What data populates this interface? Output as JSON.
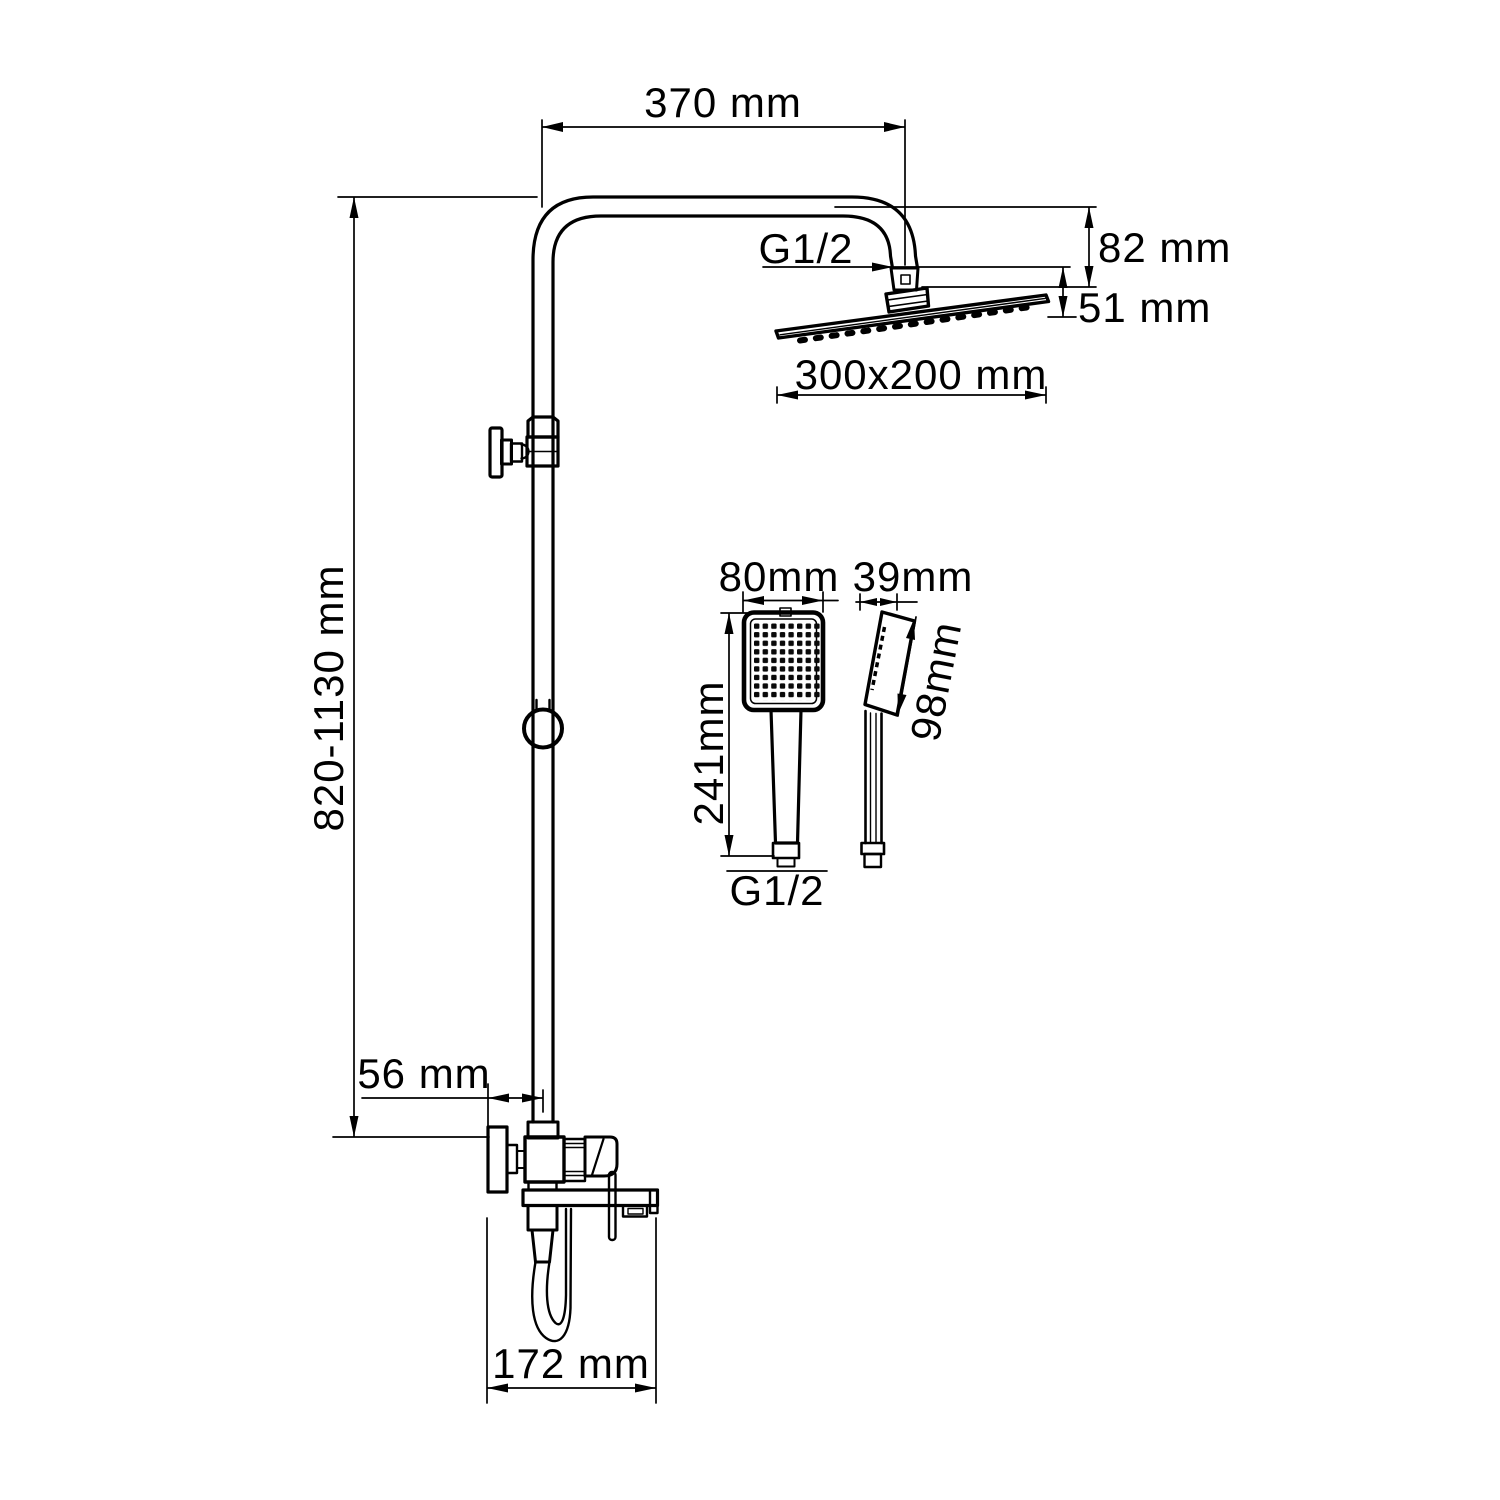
{
  "drawing": {
    "title": "Shower column technical dimension drawing",
    "line_color": "#000000",
    "background_color": "#ffffff"
  },
  "labels": {
    "arm_reach": "370 mm",
    "head_drop": "82 mm",
    "head_joint_height": "51 mm",
    "top_thread": "G1/2",
    "rain_head_size": "300x200 mm",
    "column_height_range": "820-1130 mm",
    "wall_to_pipe": "56 mm",
    "spout_depth": "172 mm",
    "hand_shower_width": "80mm",
    "hand_shower_depth": "39mm",
    "hand_shower_length": "241mm",
    "hand_shower_head_length": "98mm",
    "hand_shower_thread": "G1/2"
  }
}
